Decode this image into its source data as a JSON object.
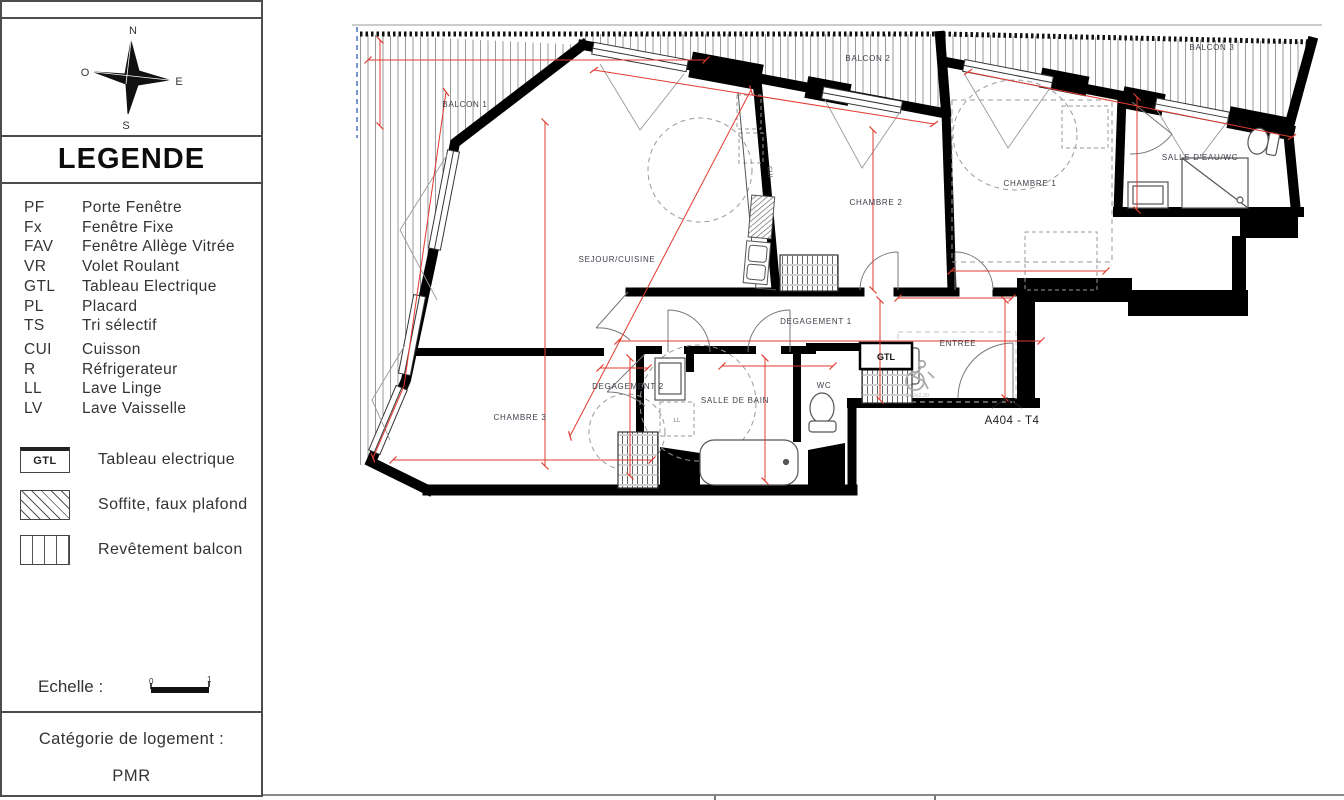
{
  "compass": {
    "north": "N",
    "south": "S",
    "east": "E",
    "west": "O"
  },
  "legend": {
    "title": "LEGENDE",
    "items": [
      {
        "abbr": "PF",
        "label": "Porte Fenêtre"
      },
      {
        "abbr": "Fx",
        "label": "Fenêtre Fixe"
      },
      {
        "abbr": "FAV",
        "label": "Fenêtre Allège Vitrée"
      },
      {
        "abbr": "VR",
        "label": "Volet Roulant"
      },
      {
        "abbr": "GTL",
        "label": "Tableau Electrique"
      },
      {
        "abbr": "PL",
        "label": "Placard"
      },
      {
        "abbr": "TS",
        "label": "Tri sélectif"
      },
      {
        "abbr": "CUI",
        "label": "Cuisson"
      },
      {
        "abbr": "R",
        "label": "Réfrigerateur"
      },
      {
        "abbr": "LL",
        "label": "Lave Linge"
      },
      {
        "abbr": "LV",
        "label": "Lave Vaisselle"
      }
    ],
    "symbols": [
      {
        "key": "GTL",
        "label": "Tableau electrique"
      },
      {
        "key": "soffite",
        "label": "Soffite, faux plafond"
      },
      {
        "key": "balcon",
        "label": "Revêtement balcon"
      }
    ],
    "scale": {
      "label": "Echelle :",
      "start": "0",
      "end": "1"
    },
    "category": {
      "label": "Catégorie de logement :",
      "value": "PMR"
    }
  },
  "plan": {
    "unit": "A404 - T4",
    "rooms": {
      "balcon1": "BALCON 1",
      "balcon2": "BALCON 2",
      "balcon3": "BALCON 3",
      "sejour": "SEJOUR/CUISINE",
      "chambre1": "CHAMBRE 1",
      "chambre2": "CHAMBRE 2",
      "chambre3": "CHAMBRE 3",
      "salle_eau": "SALLE D'EAU/WC",
      "degagement1": "DEGAGEMENT 1",
      "degagement2": "DEGAGEMENT 2",
      "salle_de_bain": "SALLE DE BAIN",
      "wc": "WC",
      "entree": "ENTREE"
    },
    "tags": {
      "gtl": "GTL",
      "cui": "CUI",
      "ll": "LL",
      "clearance": "1,20x2,20"
    },
    "colors": {
      "dimension": "#e03a2f",
      "wall": "#000000",
      "stripes": "#9a9a9a",
      "label": "#3e3e4a"
    }
  }
}
